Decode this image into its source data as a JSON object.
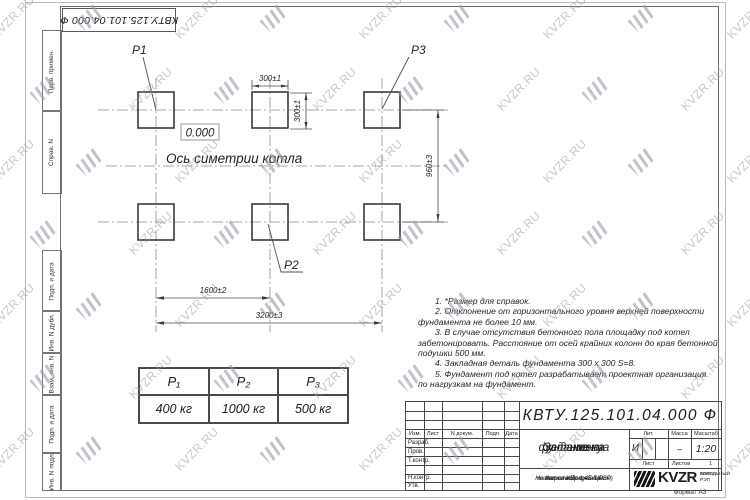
{
  "watermark": {
    "text": "KVZR.RU"
  },
  "top_stamp": "КВТУ.125.101.04.000  Ф",
  "frame_columns": [
    "Перв. примен.",
    "Справ. N",
    "Подп. и дата",
    "Инв. N дубл.",
    "Взам. инв. N",
    "Подп. и дата",
    "Инв. N подл."
  ],
  "drawing": {
    "point_labels": {
      "p1": "Р1",
      "p2": "Р2",
      "p3": "Р3"
    },
    "level_mark": "0.000",
    "axis_label": "Ось симетрии котла",
    "dim_square_width": "300±1",
    "dim_square_height": "300±1",
    "dim_rows": "960±3",
    "dim_half": "1600±2",
    "dim_total": "3200±3"
  },
  "loads_table": {
    "headers": [
      "Р₁",
      "Р₂",
      "Р₃"
    ],
    "values": [
      "400 кг",
      "1000 кг",
      "500 кг"
    ]
  },
  "notes": [
    "1. *Размер для справок.",
    "2. Отклонение от горизонтального уровня верхней поверхности",
    "фундамента не более 10 мм.",
    "3. В случае отсутствия бетонного пола площадку под котел",
    "забетонировать. Расстояние от осей крайних колонн до края бетонной",
    "подушки 500 мм.",
    "4. Закладная деталь фундамента  300 x 300 S=8.",
    "5. Фундамент под котел разрабатывает проектная организация",
    "по нагрузкам на фундамент."
  ],
  "title_block": {
    "doc_number": "КВТУ.125.101.04.000  Ф",
    "title_lines": [
      "Задание на",
      "установку",
      "фундамента"
    ],
    "subtitle_lines": [
      "Котел водогрейный",
      "Heatexpert-КВр-1,45-К(РВР)",
      "по техническому заданию"
    ],
    "header_cells": [
      "Изм.",
      "Лист",
      "N докум.",
      "Подп.",
      "Дата"
    ],
    "row_labels": [
      "Разраб.",
      "Пров.",
      "Т.контр.",
      "",
      "Н.контр.",
      "Утв."
    ],
    "lit_label": "Лит.",
    "lit_value": "И",
    "mass_label": "Масса",
    "mass_value": "–",
    "scale_label": "Масштаб",
    "scale_value": "1:20",
    "sheet_label": "Лист",
    "sheets_label": "Листов",
    "sheets_value": "1",
    "logo_text": "KVZR",
    "logo_caption_lines": [
      "КОТЕЛЬНЫЙ",
      "ЗАВОД РЭП"
    ]
  },
  "format_label": "Формат А3"
}
